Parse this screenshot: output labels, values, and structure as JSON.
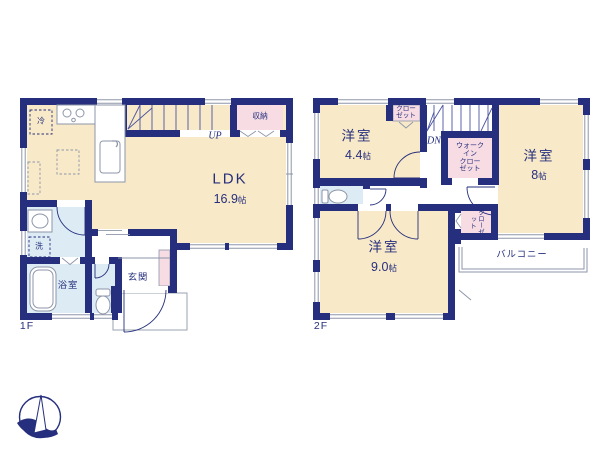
{
  "palette": {
    "wall_navy": "#262f7d",
    "room_cream": "#f8e9c8",
    "closet_pink": "#f7dce3",
    "wet_blue": "#dcebf4",
    "line_gray": "#8d96a8",
    "background": "#ffffff"
  },
  "floor1": {
    "floor_label": "1F",
    "ldk": {
      "name": "LDK",
      "size": "16.9",
      "unit": "帖"
    },
    "storage_label": "収納",
    "fridge_label": "冷",
    "stairs_label": "UP",
    "laundry_label": "洗",
    "bathroom_label": "浴室",
    "entrance_label": "玄関"
  },
  "floor2": {
    "floor_label": "2F",
    "bedroom_small": {
      "name": "洋室",
      "size": "4.4",
      "unit": "帖"
    },
    "bedroom_mid": {
      "name": "洋室",
      "size": "8",
      "unit": "帖"
    },
    "bedroom_large": {
      "name": "洋室",
      "size": "9.0",
      "unit": "帖"
    },
    "closet_top_label": "クロー\nゼット",
    "walkin_closet_label": "ウォーク\nイン\nクロー\nゼット",
    "closet_side_label": "クローゼット",
    "balcony_label": "バルコニー",
    "stairs_label": "DN"
  }
}
